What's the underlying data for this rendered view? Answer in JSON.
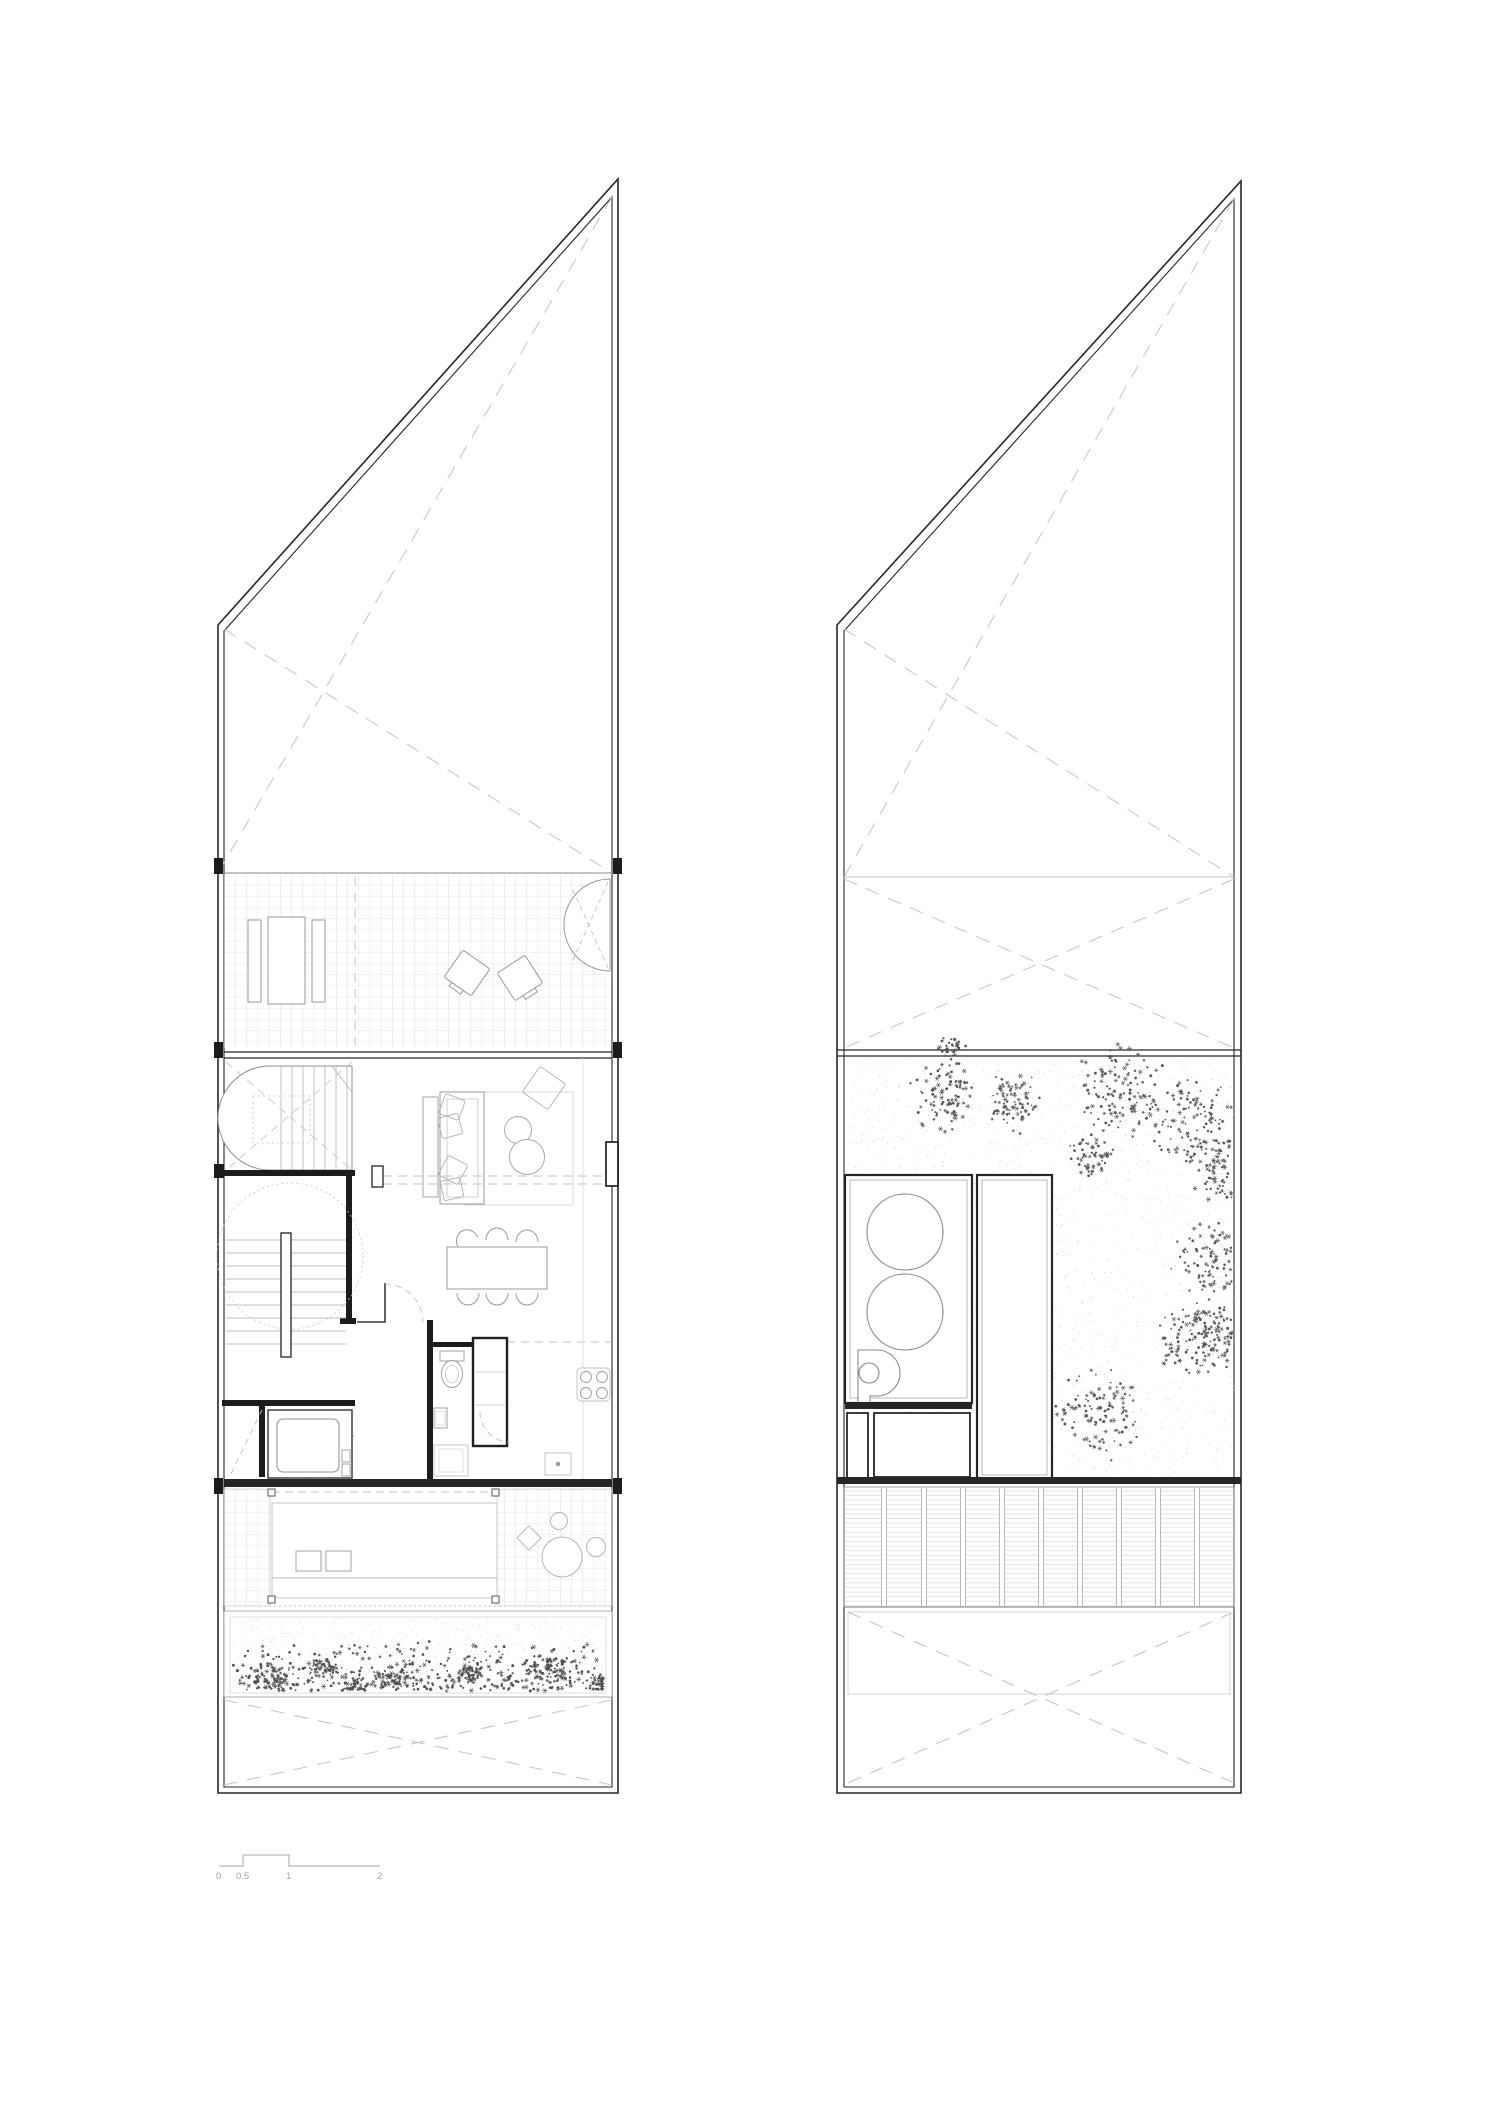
{
  "scale_bar": {
    "labels": [
      "0",
      "0.5",
      "1",
      "2"
    ]
  },
  "colors": {
    "background": "#ffffff",
    "wall_dark": "#262626",
    "line_mid": "#8f8f8f",
    "line_light": "#c6c6c6",
    "dash_gray": "#c2c2c2",
    "vegetation_dark": "#4f4f4f",
    "speckle_light": "#d9d9d9"
  },
  "vegetation": {
    "left_bed": {
      "inner_rect": [
        232,
        1619,
        372,
        72
      ],
      "speckle": 620,
      "field_marks": 430,
      "clusters": [
        [
          272,
          1678,
          26
        ],
        [
          322,
          1668,
          20
        ],
        [
          354,
          1686,
          15
        ],
        [
          392,
          1678,
          22
        ],
        [
          470,
          1675,
          18
        ],
        [
          546,
          1668,
          27
        ],
        [
          600,
          1684,
          19
        ]
      ]
    },
    "right_courtyard": {
      "rect": [
        852,
        1060,
        382,
        413
      ],
      "speckle": 2000,
      "clusters": [
        [
          945,
          1095,
          40
        ],
        [
          1012,
          1103,
          34
        ],
        [
          1120,
          1090,
          52
        ],
        [
          1192,
          1122,
          50
        ],
        [
          1228,
          1170,
          40
        ],
        [
          1216,
          1262,
          46
        ],
        [
          1228,
          1332,
          38
        ],
        [
          1092,
          1155,
          24
        ],
        [
          1100,
          1412,
          50
        ],
        [
          1192,
          1340,
          42
        ],
        [
          952,
          1046,
          15
        ]
      ]
    }
  }
}
